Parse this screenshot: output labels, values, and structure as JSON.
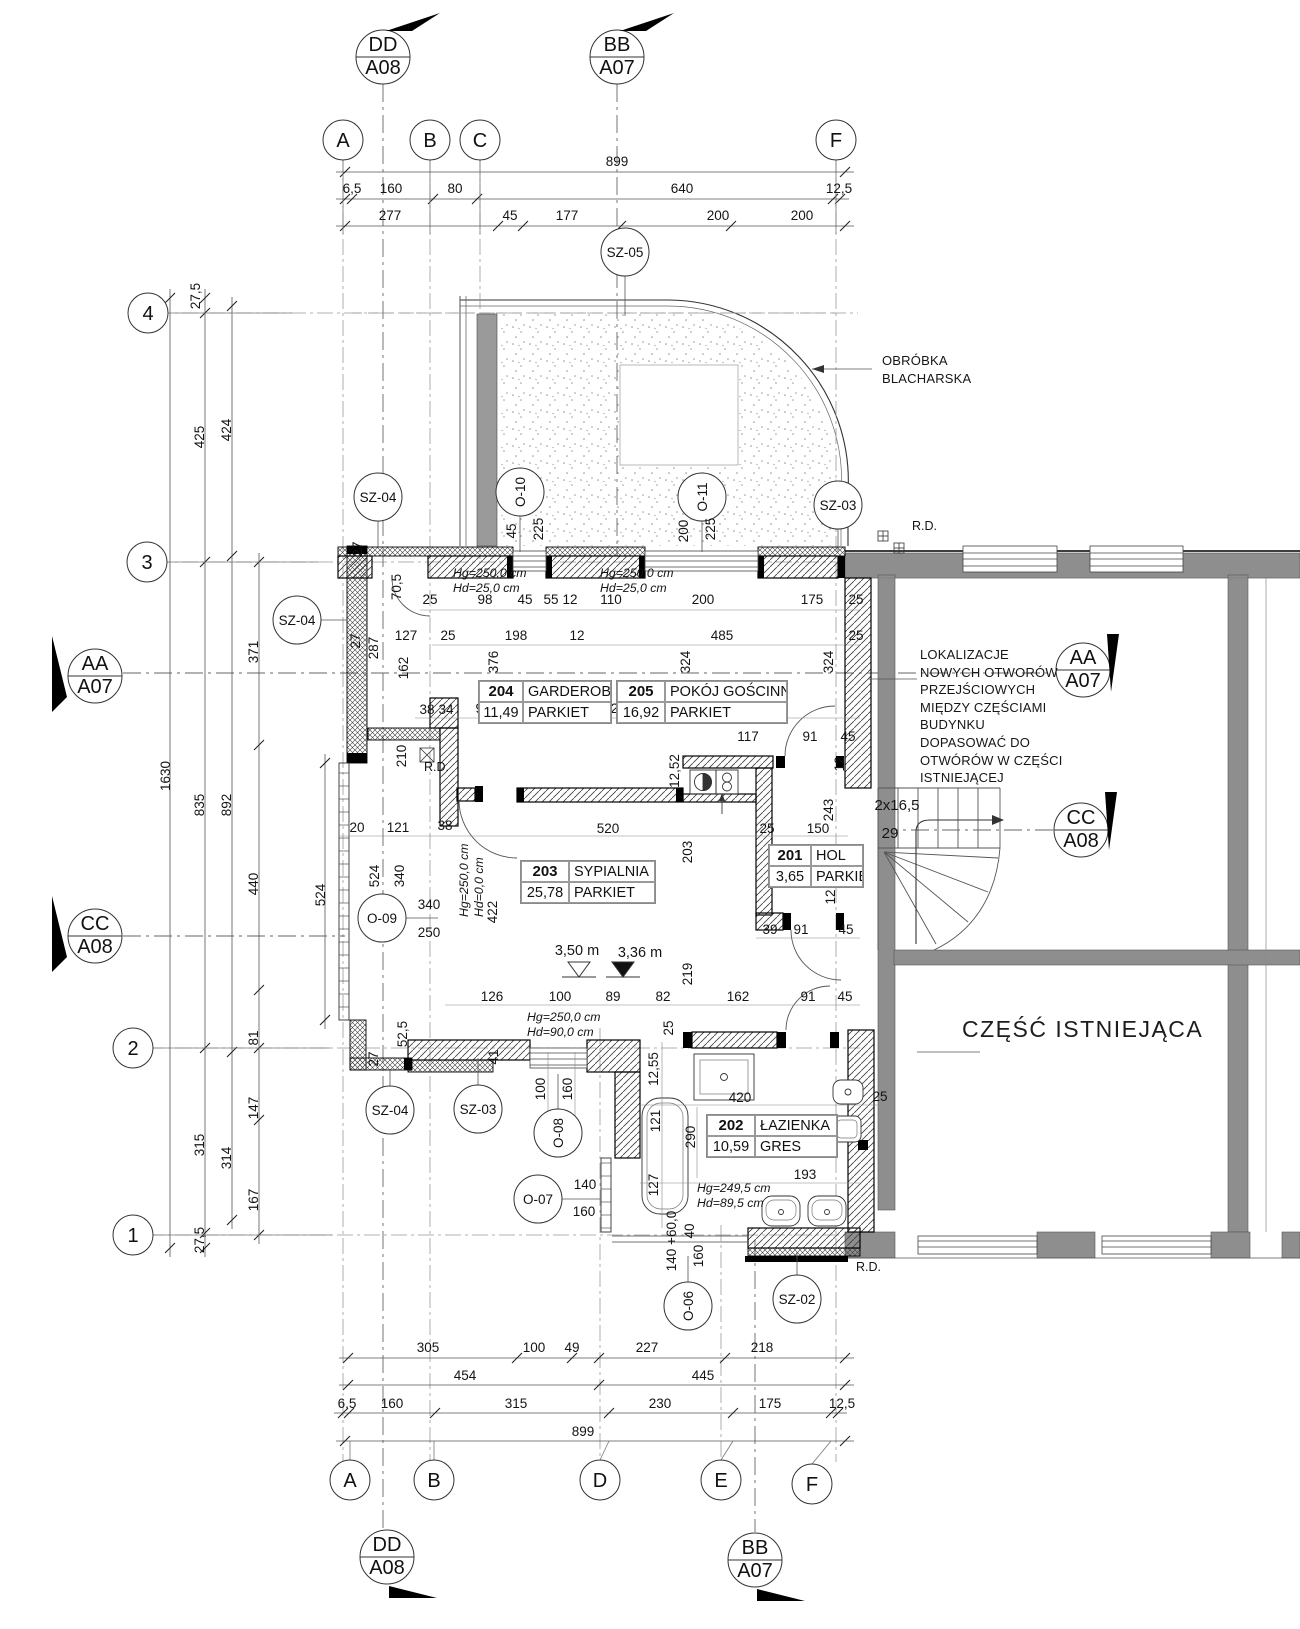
{
  "colors": {
    "existing_wall": "#8e8e8e",
    "line": "#141414"
  },
  "section_markers": [
    {
      "id": "dd-top",
      "line1": "DD",
      "line2": "A08",
      "x": 383,
      "y": 57,
      "flag": "386,31 440,13 412,31"
    },
    {
      "id": "bb-top",
      "line1": "BB",
      "line2": "A07",
      "x": 617,
      "y": 57,
      "flag": "620,31 674,13 646,31"
    },
    {
      "id": "aa-left",
      "line1": "AA",
      "line2": "A07",
      "x": 95,
      "y": 676,
      "flag": "52,712 52,636 67,697"
    },
    {
      "id": "cc-left",
      "line1": "CC",
      "line2": "A08",
      "x": 95,
      "y": 936,
      "flag": "52,972 52,896 67,957"
    },
    {
      "id": "aa-right",
      "line1": "AA",
      "line2": "A07",
      "x": 1083,
      "y": 670,
      "flag": "1107,634 1119,634 1111,692"
    },
    {
      "id": "cc-right",
      "line1": "CC",
      "line2": "A08",
      "x": 1081,
      "y": 830,
      "flag": "1105,792 1117,792 1109,850"
    },
    {
      "id": "dd-bottom",
      "line1": "DD",
      "line2": "A08",
      "x": 387,
      "y": 1557,
      "flag": "389,1586 437,1598 389,1598"
    },
    {
      "id": "bb-bottom",
      "line1": "BB",
      "line2": "A07",
      "x": 755,
      "y": 1560,
      "flag": "757,1589 805,1601 757,1601"
    }
  ],
  "grid_bubbles": [
    {
      "label": "A",
      "x": 343,
      "y": 140
    },
    {
      "label": "B",
      "x": 430,
      "y": 140
    },
    {
      "label": "C",
      "x": 480,
      "y": 140
    },
    {
      "label": "F",
      "x": 836,
      "y": 140
    },
    {
      "label": "A",
      "x": 350,
      "y": 1480
    },
    {
      "label": "B",
      "x": 434,
      "y": 1480
    },
    {
      "label": "D",
      "x": 600,
      "y": 1480
    },
    {
      "label": "E",
      "x": 721,
      "y": 1480
    },
    {
      "label": "F",
      "x": 812,
      "y": 1484
    },
    {
      "label": "4",
      "x": 148,
      "y": 313
    },
    {
      "label": "3",
      "x": 147,
      "y": 562
    },
    {
      "label": "2",
      "x": 133,
      "y": 1048
    },
    {
      "label": "1",
      "x": 133,
      "y": 1235
    }
  ],
  "ref_circles": [
    {
      "label": "SZ-05",
      "x": 625,
      "y": 252,
      "rot": false,
      "leader": [
        625,
        276,
        625,
        316
      ]
    },
    {
      "label": "SZ-04",
      "x": 378,
      "y": 497,
      "rot": false,
      "leader": [
        378,
        521,
        378,
        547
      ]
    },
    {
      "label": "O-10",
      "x": 520,
      "y": 492,
      "rot": true,
      "leader": [
        520,
        516,
        520,
        552
      ]
    },
    {
      "label": "O-11",
      "x": 702,
      "y": 497,
      "rot": true,
      "leader": [
        702,
        521,
        702,
        552
      ]
    },
    {
      "label": "SZ-03",
      "x": 838,
      "y": 505,
      "rot": false,
      "leader": [
        838,
        529,
        838,
        552
      ]
    },
    {
      "label": "SZ-04",
      "x": 297,
      "y": 620,
      "rot": false,
      "leader": [
        321,
        620,
        347,
        620
      ]
    },
    {
      "label": "O-09",
      "x": 382,
      "y": 918,
      "rot": false,
      "leader": [
        406,
        918,
        438,
        918
      ]
    },
    {
      "label": "SZ-04",
      "x": 390,
      "y": 1110,
      "rot": false,
      "leader": [
        390,
        1086,
        390,
        1070
      ]
    },
    {
      "label": "SZ-03",
      "x": 478,
      "y": 1109,
      "rot": false,
      "leader": [
        478,
        1085,
        478,
        1058
      ]
    },
    {
      "label": "O-08",
      "x": 558,
      "y": 1133,
      "rot": true,
      "leader": [
        558,
        1109,
        558,
        1074
      ]
    },
    {
      "label": "O-07",
      "x": 538,
      "y": 1199,
      "rot": false,
      "leader": [
        562,
        1199,
        600,
        1199
      ]
    },
    {
      "label": "O-06",
      "x": 688,
      "y": 1306,
      "rot": true,
      "leader": [
        688,
        1282,
        688,
        1256
      ]
    },
    {
      "label": "SZ-02",
      "x": 797,
      "y": 1299,
      "rot": false,
      "leader": [
        797,
        1275,
        797,
        1252
      ]
    }
  ],
  "rooms": [
    {
      "number": "204",
      "name": "GARDEROBA",
      "area": "11,49",
      "floor": "PARKIET",
      "x": 478,
      "y": 680,
      "w": 132,
      "nw": 44
    },
    {
      "number": "205",
      "name": "POKÓJ GOŚCINNY",
      "area": "16,92",
      "floor": "PARKIET",
      "x": 616,
      "y": 680,
      "w": 170,
      "nw": 48
    },
    {
      "number": "203",
      "name": "SYPIALNIA",
      "area": "25,78",
      "floor": "PARKIET",
      "x": 520,
      "y": 860,
      "w": 134,
      "nw": 48
    },
    {
      "number": "201",
      "name": "HOL",
      "area": "3,65",
      "floor": "PARKIET",
      "x": 768,
      "y": 844,
      "w": 94,
      "nw": 42
    },
    {
      "number": "202",
      "name": "ŁAZIENKA",
      "area": "10,59",
      "floor": "GRES",
      "x": 706,
      "y": 1114,
      "w": 130,
      "nw": 48
    }
  ],
  "notes": {
    "obrobka": [
      "OBRÓBKA",
      "BLACHARSKA"
    ],
    "lokalizacje": [
      "LOKALIZACJE",
      "NOWYCH OTWORÓW",
      "PRZEJŚCIOWYCH",
      "MIĘDZY CZĘŚCIAMI",
      "BUDYNKU",
      "DOPASOWAĆ DO",
      "OTWÓRÓW W CZĘŚCI",
      "ISTNIEJĄCEJ"
    ],
    "existing_part": "CZĘŚĆ ISTNIEJĄCA",
    "rd": "R.D.",
    "rd_positions": [
      {
        "x": 912,
        "y": 530
      },
      {
        "x": 424,
        "y": 771
      },
      {
        "x": 856,
        "y": 1271
      }
    ],
    "stairs_riser": "2x16,5",
    "stairs_count": "29",
    "levels": [
      {
        "value": "3,50 m",
        "x": 577,
        "y": 955,
        "tx": 579,
        "filled": false
      },
      {
        "value": "3,36 m",
        "x": 640,
        "y": 957,
        "tx": 623,
        "filled": true
      }
    ],
    "hghd": [
      {
        "x": 453,
        "y": 577,
        "rot": false,
        "lines": [
          "Hg=250,0 cm",
          "Hd=25,0 cm"
        ]
      },
      {
        "x": 600,
        "y": 577,
        "rot": false,
        "lines": [
          "Hg=250,0 cm",
          "Hd=25,0 cm"
        ]
      },
      {
        "x": 468,
        "y": 917,
        "rot": true,
        "lines": [
          "Hg=250,0 cm",
          "Hd=0,0 cm"
        ]
      },
      {
        "x": 527,
        "y": 1021,
        "rot": false,
        "lines": [
          "Hg=250,0 cm",
          "Hd=90,0 cm"
        ]
      },
      {
        "x": 697,
        "y": 1192,
        "rot": false,
        "lines": [
          "Hg=249,5 cm",
          "Hd=89,5 cm"
        ]
      }
    ]
  },
  "dimensions": [
    {
      "t": "899",
      "x": 617,
      "y": 166
    },
    {
      "t": "6,5",
      "x": 352,
      "y": 193
    },
    {
      "t": "160",
      "x": 391,
      "y": 193
    },
    {
      "t": "80",
      "x": 455,
      "y": 193
    },
    {
      "t": "640",
      "x": 682,
      "y": 193
    },
    {
      "t": "12,5",
      "x": 839,
      "y": 193
    },
    {
      "t": "277",
      "x": 390,
      "y": 220
    },
    {
      "t": "45",
      "x": 510,
      "y": 220
    },
    {
      "t": "177",
      "x": 567,
      "y": 220
    },
    {
      "t": "200",
      "x": 718,
      "y": 220
    },
    {
      "t": "200",
      "x": 802,
      "y": 220
    },
    {
      "t": "27,5",
      "x": 200,
      "y": 296,
      "r": 1
    },
    {
      "t": "425",
      "x": 204,
      "y": 437,
      "r": 1
    },
    {
      "t": "424",
      "x": 231,
      "y": 430,
      "r": 1
    },
    {
      "t": "371",
      "x": 258,
      "y": 652,
      "r": 1
    },
    {
      "t": "1630",
      "x": 170,
      "y": 776,
      "r": 1
    },
    {
      "t": "835",
      "x": 204,
      "y": 805,
      "r": 1
    },
    {
      "t": "892",
      "x": 231,
      "y": 805,
      "r": 1
    },
    {
      "t": "440",
      "x": 258,
      "y": 884,
      "r": 1
    },
    {
      "t": "524",
      "x": 325,
      "y": 895,
      "r": 1
    },
    {
      "t": "81",
      "x": 258,
      "y": 1038,
      "r": 1
    },
    {
      "t": "147",
      "x": 258,
      "y": 1108,
      "r": 1
    },
    {
      "t": "315",
      "x": 204,
      "y": 1145,
      "r": 1
    },
    {
      "t": "314",
      "x": 231,
      "y": 1158,
      "r": 1
    },
    {
      "t": "167",
      "x": 258,
      "y": 1200,
      "r": 1
    },
    {
      "t": "27,5",
      "x": 204,
      "y": 1240,
      "r": 1
    },
    {
      "t": "305",
      "x": 428,
      "y": 1352
    },
    {
      "t": "100",
      "x": 534,
      "y": 1352
    },
    {
      "t": "49",
      "x": 572,
      "y": 1352
    },
    {
      "t": "227",
      "x": 647,
      "y": 1352
    },
    {
      "t": "218",
      "x": 762,
      "y": 1352
    },
    {
      "t": "454",
      "x": 465,
      "y": 1380
    },
    {
      "t": "445",
      "x": 703,
      "y": 1380
    },
    {
      "t": "6,5",
      "x": 347,
      "y": 1408
    },
    {
      "t": "160",
      "x": 392,
      "y": 1408
    },
    {
      "t": "315",
      "x": 516,
      "y": 1408
    },
    {
      "t": "230",
      "x": 660,
      "y": 1408
    },
    {
      "t": "175",
      "x": 770,
      "y": 1408
    },
    {
      "t": "12,5",
      "x": 842,
      "y": 1408
    },
    {
      "t": "899",
      "x": 583,
      "y": 1436
    },
    {
      "t": "45",
      "x": 516,
      "y": 531,
      "r": 1
    },
    {
      "t": "225",
      "x": 543,
      "y": 529,
      "r": 1
    },
    {
      "t": "200",
      "x": 688,
      "y": 531,
      "r": 1
    },
    {
      "t": "225",
      "x": 715,
      "y": 529,
      "r": 1
    },
    {
      "t": "27",
      "x": 362,
      "y": 549,
      "r": 1
    },
    {
      "t": "70,5",
      "x": 401,
      "y": 587,
      "r": 1
    },
    {
      "t": "25",
      "x": 430,
      "y": 604
    },
    {
      "t": "98",
      "x": 485,
      "y": 604
    },
    {
      "t": "45",
      "x": 525,
      "y": 604
    },
    {
      "t": "55",
      "x": 551,
      "y": 604
    },
    {
      "t": "12",
      "x": 570,
      "y": 604
    },
    {
      "t": "110",
      "x": 611,
      "y": 604
    },
    {
      "t": "200",
      "x": 703,
      "y": 604
    },
    {
      "t": "175",
      "x": 812,
      "y": 604
    },
    {
      "t": "25",
      "x": 856,
      "y": 604
    },
    {
      "t": "25",
      "x": 448,
      "y": 640
    },
    {
      "t": "198",
      "x": 516,
      "y": 640
    },
    {
      "t": "12",
      "x": 577,
      "y": 640
    },
    {
      "t": "485",
      "x": 722,
      "y": 640
    },
    {
      "t": "25",
      "x": 856,
      "y": 640
    },
    {
      "t": "376",
      "x": 498,
      "y": 662,
      "r": 1
    },
    {
      "t": "324",
      "x": 690,
      "y": 662,
      "r": 1
    },
    {
      "t": "324",
      "x": 833,
      "y": 662,
      "r": 1
    },
    {
      "t": "27",
      "x": 360,
      "y": 641,
      "r": 1
    },
    {
      "t": "287",
      "x": 378,
      "y": 648,
      "r": 1
    },
    {
      "t": "127",
      "x": 406,
      "y": 640
    },
    {
      "t": "162",
      "x": 408,
      "y": 668,
      "r": 1
    },
    {
      "t": "38",
      "x": 427,
      "y": 714
    },
    {
      "t": "34",
      "x": 446,
      "y": 714
    },
    {
      "t": "91",
      "x": 483,
      "y": 713
    },
    {
      "t": "73",
      "x": 532,
      "y": 713
    },
    {
      "t": "12",
      "x": 556,
      "y": 713
    },
    {
      "t": "232",
      "x": 622,
      "y": 713
    },
    {
      "t": "117",
      "x": 748,
      "y": 741
    },
    {
      "t": "91",
      "x": 810,
      "y": 741
    },
    {
      "t": "45",
      "x": 848,
      "y": 741
    },
    {
      "t": "12",
      "x": 844,
      "y": 764,
      "r": 1
    },
    {
      "t": "12,52",
      "x": 679,
      "y": 771,
      "r": 1
    },
    {
      "t": "210",
      "x": 406,
      "y": 756,
      "r": 1
    },
    {
      "t": "243",
      "x": 833,
      "y": 810,
      "r": 1
    },
    {
      "t": "203",
      "x": 692,
      "y": 852,
      "r": 1
    },
    {
      "t": "20",
      "x": 357,
      "y": 832
    },
    {
      "t": "121",
      "x": 398,
      "y": 832
    },
    {
      "t": "38",
      "x": 445,
      "y": 830
    },
    {
      "t": "520",
      "x": 608,
      "y": 833
    },
    {
      "t": "25",
      "x": 767,
      "y": 833
    },
    {
      "t": "150",
      "x": 818,
      "y": 833
    },
    {
      "t": "524",
      "x": 379,
      "y": 876,
      "r": 1
    },
    {
      "t": "340",
      "x": 404,
      "y": 876,
      "r": 1
    },
    {
      "t": "340",
      "x": 429,
      "y": 909
    },
    {
      "t": "250",
      "x": 429,
      "y": 937
    },
    {
      "t": "422",
      "x": 497,
      "y": 912,
      "r": 1
    },
    {
      "t": "12",
      "x": 835,
      "y": 897,
      "r": 1
    },
    {
      "t": "39",
      "x": 770,
      "y": 934
    },
    {
      "t": "91",
      "x": 801,
      "y": 934
    },
    {
      "t": "45",
      "x": 846,
      "y": 934
    },
    {
      "t": "219",
      "x": 692,
      "y": 974,
      "r": 1
    },
    {
      "t": "126",
      "x": 492,
      "y": 1001
    },
    {
      "t": "100",
      "x": 560,
      "y": 1001
    },
    {
      "t": "89",
      "x": 613,
      "y": 1001
    },
    {
      "t": "82",
      "x": 663,
      "y": 1001
    },
    {
      "t": "162",
      "x": 738,
      "y": 1001
    },
    {
      "t": "91",
      "x": 808,
      "y": 1001
    },
    {
      "t": "45",
      "x": 845,
      "y": 1001
    },
    {
      "t": "52,5",
      "x": 407,
      "y": 1034,
      "r": 1
    },
    {
      "t": "27",
      "x": 378,
      "y": 1059,
      "r": 1
    },
    {
      "t": "41",
      "x": 498,
      "y": 1057,
      "r": 1
    },
    {
      "t": "25",
      "x": 673,
      "y": 1028,
      "r": 1
    },
    {
      "t": "12,55",
      "x": 658,
      "y": 1069,
      "r": 1
    },
    {
      "t": "420",
      "x": 740,
      "y": 1102
    },
    {
      "t": "121",
      "x": 660,
      "y": 1121,
      "r": 1
    },
    {
      "t": "290",
      "x": 695,
      "y": 1137,
      "r": 1
    },
    {
      "t": "127",
      "x": 658,
      "y": 1185,
      "r": 1
    },
    {
      "t": "193",
      "x": 805,
      "y": 1179
    },
    {
      "t": "25",
      "x": 880,
      "y": 1101
    },
    {
      "t": "100",
      "x": 545,
      "y": 1089,
      "r": 1
    },
    {
      "t": "160",
      "x": 572,
      "y": 1089,
      "r": 1
    },
    {
      "t": "140",
      "x": 585,
      "y": 1189
    },
    {
      "t": "160",
      "x": 584,
      "y": 1216
    },
    {
      "t": "140 +60,0",
      "x": 676,
      "y": 1241,
      "r": 1
    },
    {
      "t": "40",
      "x": 694,
      "y": 1231,
      "r": 1
    },
    {
      "t": "160",
      "x": 703,
      "y": 1256,
      "r": 1
    }
  ]
}
